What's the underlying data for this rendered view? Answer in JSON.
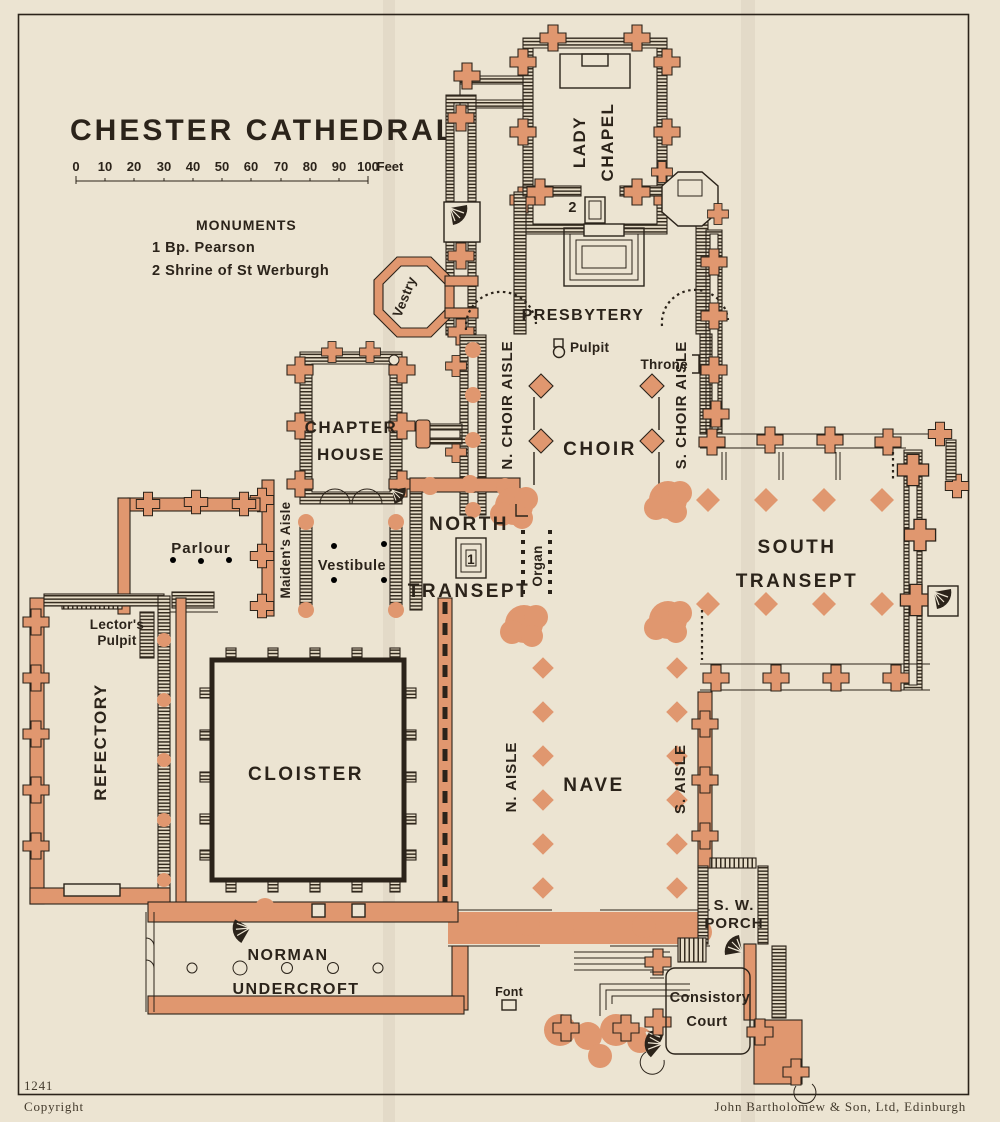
{
  "map": {
    "title": "CHESTER CATHEDRAL",
    "scale": {
      "ticks": [
        "0",
        "10",
        "20",
        "30",
        "40",
        "50",
        "60",
        "70",
        "80",
        "90",
        "100"
      ],
      "unit": "Feet"
    },
    "monuments": {
      "heading": "MONUMENTS",
      "items": [
        "1 Bp. Pearson",
        "2 Shrine of St Werburgh"
      ]
    },
    "labels": {
      "lady_chapel_1": "LADY",
      "lady_chapel_2": "CHAPEL",
      "presbytery": "PRESBYTERY",
      "vestry": "Vestry",
      "n_choir_aisle": "N. CHOIR AISLE",
      "s_choir_aisle": "S. CHOIR AISLE",
      "choir": "CHOIR",
      "pulpit": "Pulpit",
      "throne": "Throne",
      "chapter_house_1": "CHAPTER",
      "chapter_house_2": "HOUSE",
      "vestibule": "Vestibule",
      "maidens_aisle": "Maiden's Aisle",
      "parlour": "Parlour",
      "lectors_pulpit_1": "Lector's",
      "lectors_pulpit_2": "Pulpit",
      "refectory": "REFECTORY",
      "cloister": "CLOISTER",
      "north_transept_1": "NORTH",
      "north_transept_2": "TRANSEPT",
      "organ": "Organ",
      "south_transept_1": "SOUTH",
      "south_transept_2": "TRANSEPT",
      "nave": "NAVE",
      "n_aisle": "N. AISLE",
      "s_aisle": "S. AISLE",
      "sw_porch_1": "S. W.",
      "sw_porch_2": "PORCH",
      "consistory_1": "Consistory",
      "consistory_2": "Court",
      "undercroft_1": "NORMAN",
      "undercroft_2": "UNDERCROFT",
      "font": "Font"
    },
    "markers": {
      "monument_1": "1",
      "monument_2": "2"
    },
    "footer": {
      "plate_number": "1241",
      "copyright": "Copyright",
      "publisher": "John Bartholomew & Son, Ltd, Edinburgh"
    }
  },
  "colors": {
    "paper": "#ece4d2",
    "accent": "#e0976f",
    "ink": "#2b231a"
  }
}
